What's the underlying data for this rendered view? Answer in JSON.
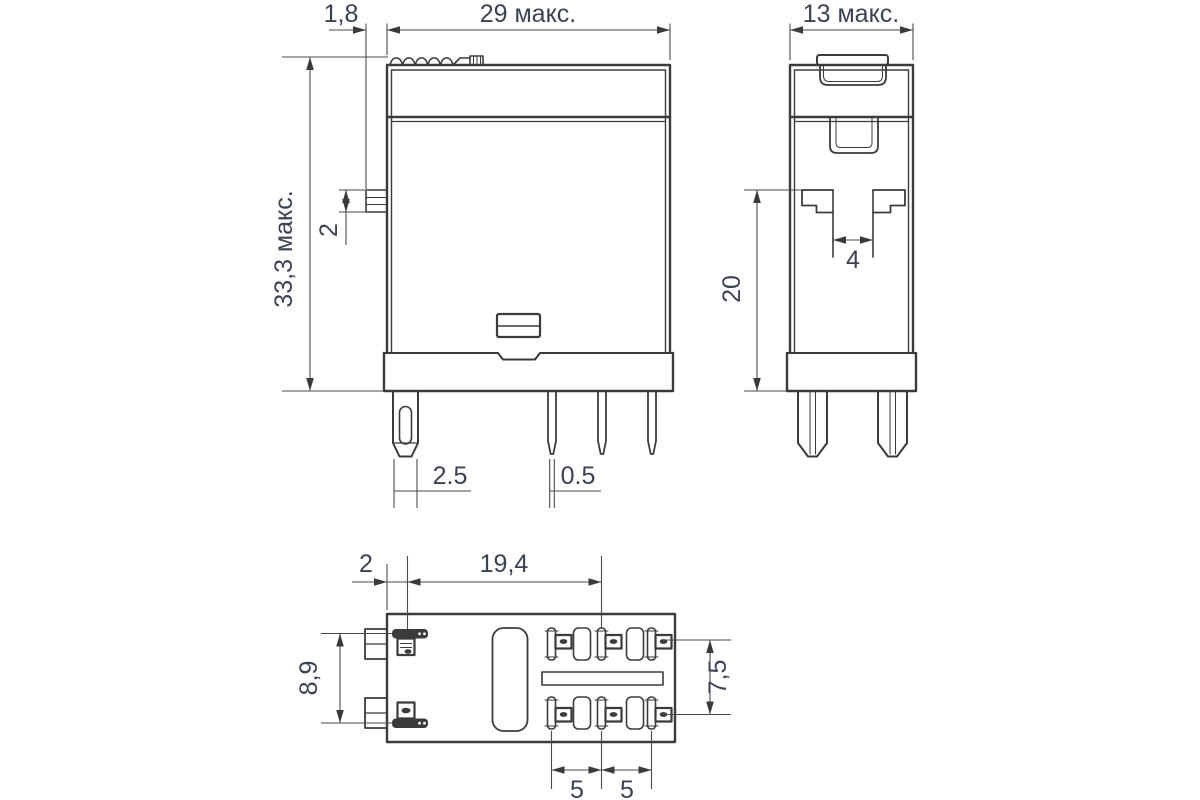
{
  "page": {
    "background": "#ffffff",
    "line_color": "#3b3b3b",
    "text_color": "#3a4353"
  },
  "front_view": {
    "width_label": "29 макс.",
    "height_label": "33,3 макс.",
    "latch_offset_label": "1,8",
    "latch_height_label": "2",
    "coil_pin_width_label": "2.5",
    "contact_pin_width_label": "0.5"
  },
  "side_view": {
    "width_label": "13 макс.",
    "mount_depth_label": "20",
    "slot_width_label": "4"
  },
  "bottom_view": {
    "edge_to_coil_label": "2",
    "coil_to_contact_label": "19,4",
    "coil_pin_span_label": "8,9",
    "contact_row_span_label": "7,5",
    "contact_pitch_label_1": "5",
    "contact_pitch_label_2": "5"
  }
}
